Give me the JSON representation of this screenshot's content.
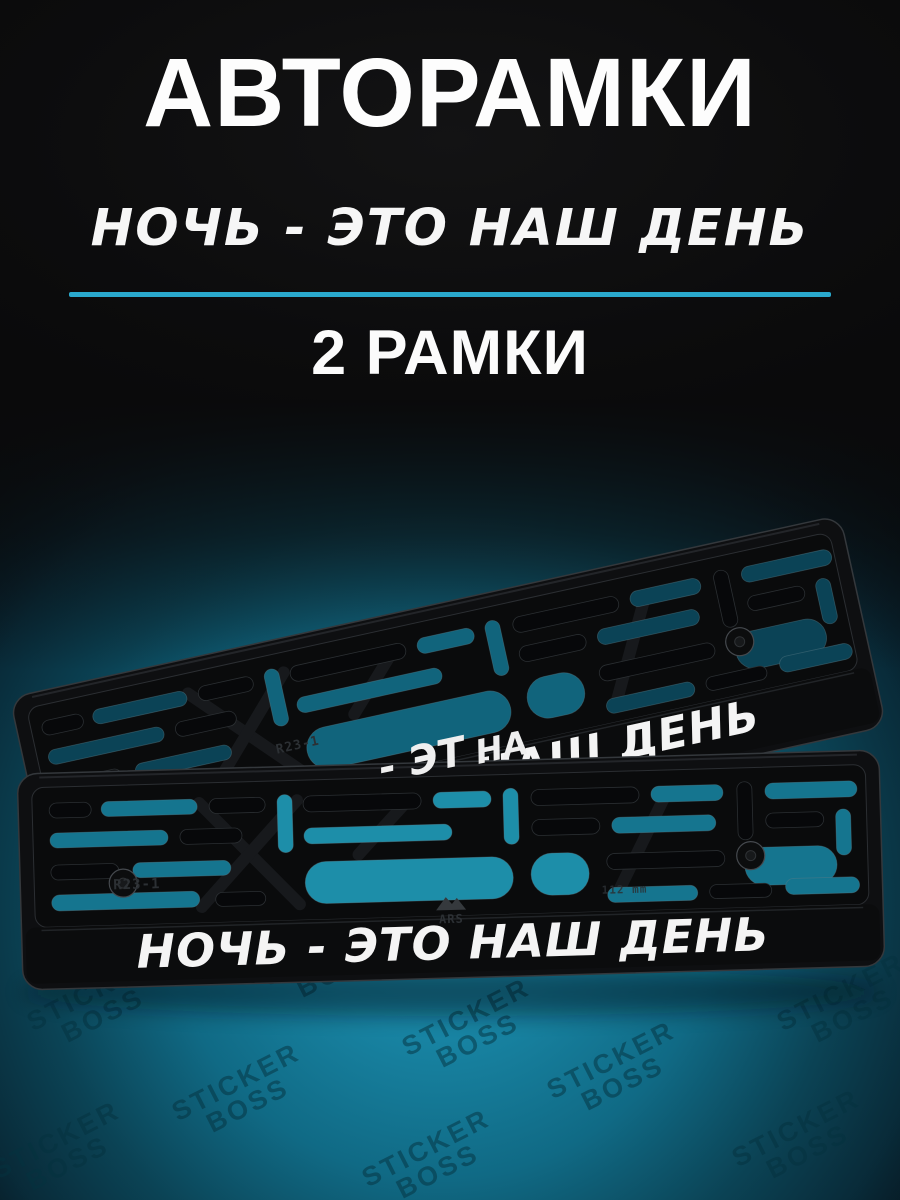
{
  "meta": {
    "accent_color": "#2aa9cd",
    "background_color": "#0a0a0b",
    "glow_color": "#1a86a5"
  },
  "header": {
    "title": "АВТОРАМКИ",
    "slogan": "НОЧЬ - ЭТО НАШ ДЕНЬ",
    "quantity": "2 РАМКИ"
  },
  "product": {
    "frame_top": {
      "plate_text": "НОЧЬ - ЭТО НАШ ДЕНЬ",
      "mold_mark": "R23-1"
    },
    "frame_bottom": {
      "plate_text": "НОЧЬ - ЭТО НАШ ДЕНЬ",
      "mold_mark": "R23-1",
      "mold_size_label": "112 mm",
      "brand_label": "ARS",
      "reflection_fragment_1": "- ЭТ",
      "reflection_fragment_2": "НА"
    },
    "watermark": {
      "line1": "STICKER",
      "line2": "BOSS"
    }
  }
}
